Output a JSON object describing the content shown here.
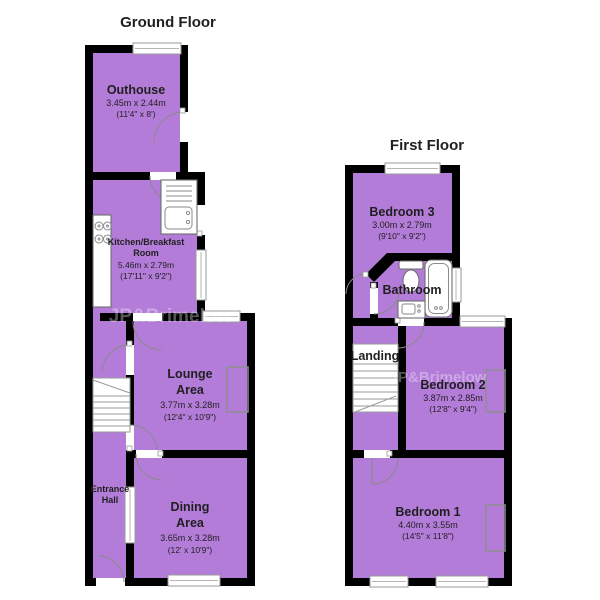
{
  "colors": {
    "room_fill": "#b47cd9",
    "wall": "#000000",
    "label": "#1f1f1f"
  },
  "watermark": {
    "text": "JP&Brimelow"
  },
  "ground_floor": {
    "title": "Ground Floor",
    "rooms": {
      "outhouse": {
        "name": "Outhouse",
        "metric": "3.45m x 2.44m",
        "imperial": "(11'4\" x 8')"
      },
      "kitchen": {
        "name_line1": "Kitchen/Breakfast",
        "name_line2": "Room",
        "metric": "5.46m x 2.79m",
        "imperial": "(17'11\" x 9'2\")"
      },
      "lounge": {
        "name_line1": "Lounge",
        "name_line2": "Area",
        "metric": "3.77m x 3.28m",
        "imperial": "(12'4\" x 10'9\")"
      },
      "entrance_hall": {
        "name_line1": "Entrance",
        "name_line2": "Hall"
      },
      "dining": {
        "name_line1": "Dining",
        "name_line2": "Area",
        "metric": "3.65m x 3.28m",
        "imperial": "(12' x 10'9\")"
      }
    }
  },
  "first_floor": {
    "title": "First Floor",
    "rooms": {
      "bedroom3": {
        "name": "Bedroom 3",
        "metric": "3.00m x 2.79m",
        "imperial": "(9'10\" x 9'2\")"
      },
      "bathroom": {
        "name": "Bathroom"
      },
      "landing": {
        "name": "Landing"
      },
      "bedroom2": {
        "name": "Bedroom 2",
        "metric": "3.87m x 2.85m",
        "imperial": "(12'8\" x 9'4\")"
      },
      "bedroom1": {
        "name": "Bedroom 1",
        "metric": "4.40m x 3.55m",
        "imperial": "(14'5\" x 11'8\")"
      }
    }
  }
}
